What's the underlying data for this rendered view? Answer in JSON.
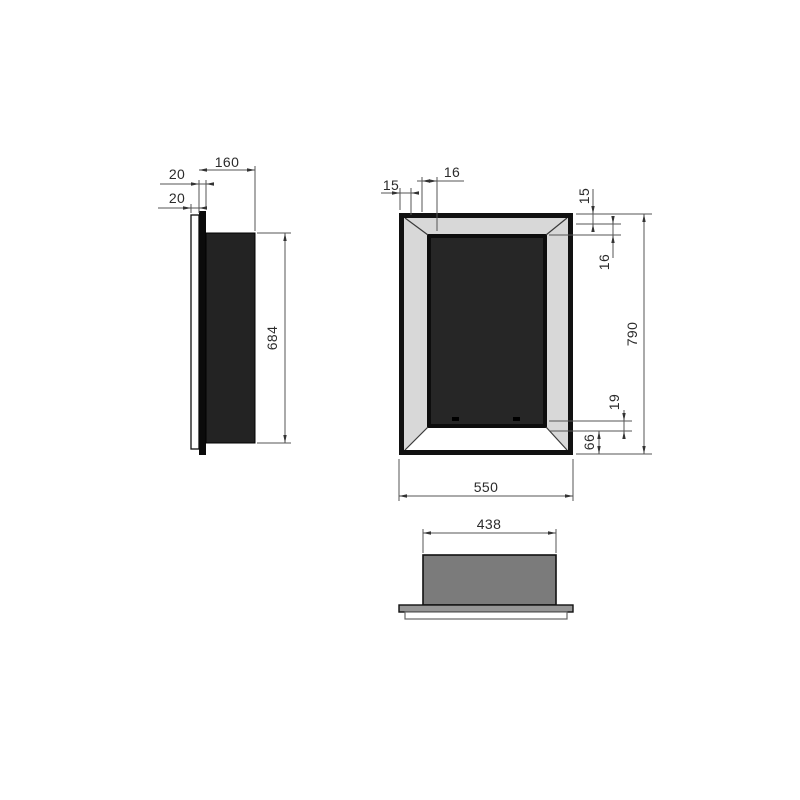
{
  "drawing": {
    "type": "technical-dimension-drawing",
    "views": [
      "side-view",
      "front-view",
      "bottom-view"
    ],
    "colors": {
      "outline": "#111111",
      "dimension_line": "#555555",
      "bevel_gray": "#d8d8d8",
      "opening_dark": "#262626",
      "body_gray": "#7b7b7b",
      "plate_gray": "#969696",
      "text": "#2b2b2b"
    }
  },
  "dimensions": {
    "side": {
      "depth": "160",
      "flange_thickness": "20",
      "plate_thickness": "20",
      "body_height": "684"
    },
    "front": {
      "frame_top_left": "15",
      "bevel_top_left": "16",
      "frame_right": "15",
      "bevel_right": "16",
      "overall_height": "790",
      "bottom_inset": "19",
      "bottom_band": "66",
      "overall_width": "550"
    },
    "bottom": {
      "body_width": "438"
    }
  }
}
